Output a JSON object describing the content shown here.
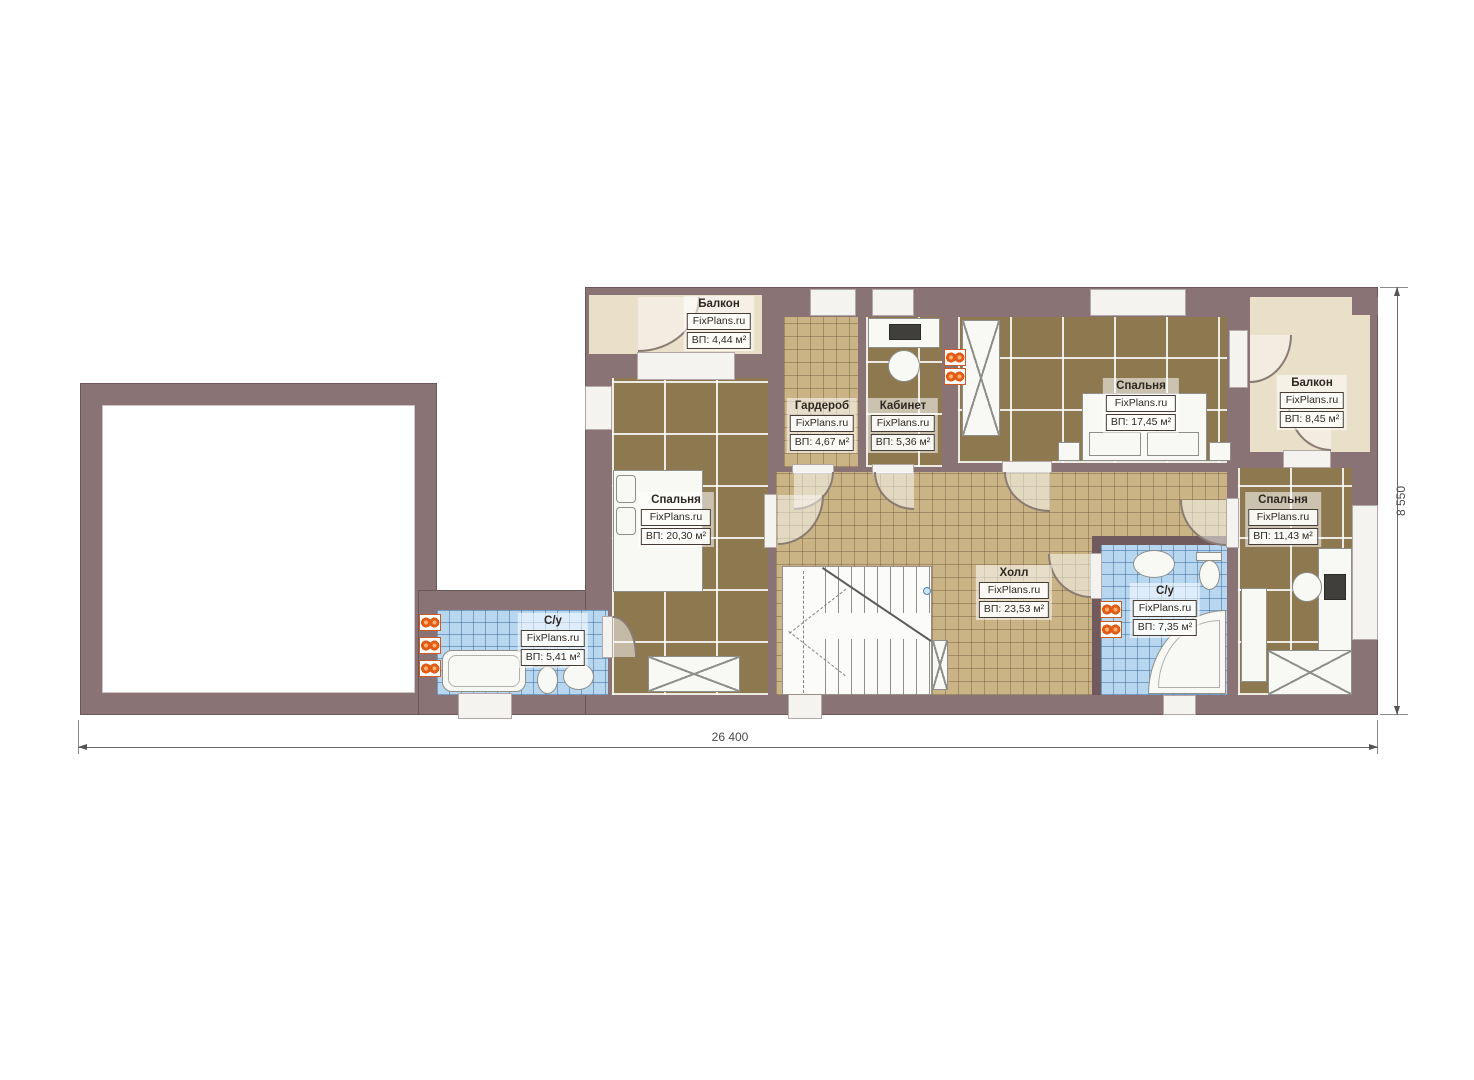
{
  "rooms": [
    {
      "key": "balcony-top-left",
      "name": "Балкон",
      "brand": "FixPlans.ru",
      "area": "ВП: 4,44 м²"
    },
    {
      "key": "wardrobe",
      "name": "Гардероб",
      "brand": "FixPlans.ru",
      "area": "ВП: 4,67 м²"
    },
    {
      "key": "office",
      "name": "Кабинет",
      "brand": "FixPlans.ru",
      "area": "ВП: 5,36 м²"
    },
    {
      "key": "bedroom-top",
      "name": "Спальня",
      "brand": "FixPlans.ru",
      "area": "ВП: 17,45 м²"
    },
    {
      "key": "balcony-right",
      "name": "Балкон",
      "brand": "FixPlans.ru",
      "area": "ВП: 8,45 м²"
    },
    {
      "key": "bedroom-left",
      "name": "Спальня",
      "brand": "FixPlans.ru",
      "area": "ВП: 20,30 м²"
    },
    {
      "key": "hall",
      "name": "Холл",
      "brand": "FixPlans.ru",
      "area": "ВП: 23,53 м²"
    },
    {
      "key": "bathroom-right",
      "name": "С/у",
      "brand": "FixPlans.ru",
      "area": "ВП: 7,35 м²"
    },
    {
      "key": "bedroom-right",
      "name": "Спальня",
      "brand": "FixPlans.ru",
      "area": "ВП: 11,43 м²"
    },
    {
      "key": "bathroom-left",
      "name": "С/у",
      "brand": "FixPlans.ru",
      "area": "ВП: 5,41 м²"
    }
  ],
  "dimensions": {
    "bottom": "26 400",
    "right": "8 550"
  },
  "colors": {
    "wall": "#8a7375",
    "carpet": "#8d7850",
    "tile_tan": "#cab486",
    "tile_blue": "#b7d7f1",
    "balcony_floor": "#eadfc9",
    "radiator": "#e35c17"
  }
}
